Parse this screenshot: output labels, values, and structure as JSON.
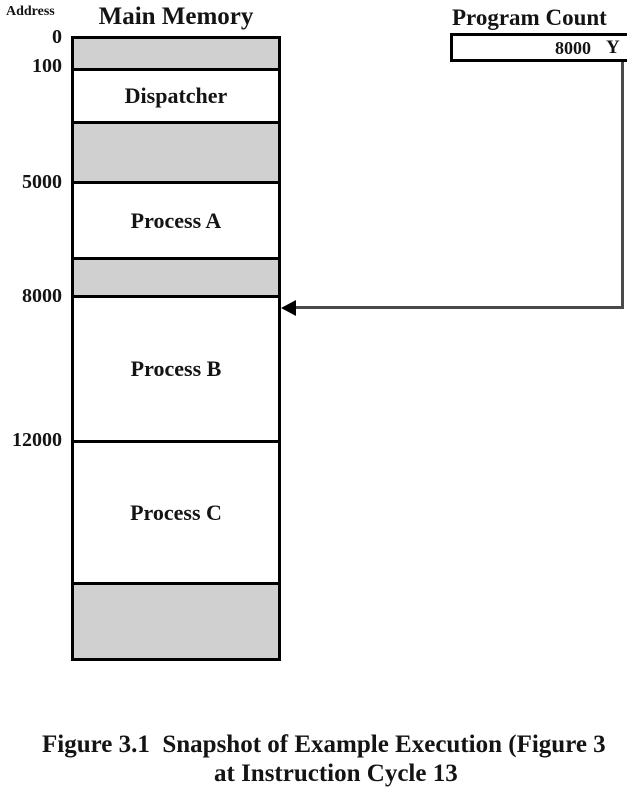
{
  "diagram": {
    "address_column_label": "Address",
    "memory": {
      "title": "Main Memory",
      "address_labels": [
        "0",
        "100",
        "5000",
        "8000",
        "12000"
      ],
      "regions": [
        {
          "start_address": "0",
          "label": "",
          "shaded": true
        },
        {
          "start_address": "100",
          "label": "Dispatcher",
          "shaded": false
        },
        {
          "start_address": "",
          "label": "",
          "shaded": true
        },
        {
          "start_address": "5000",
          "label": "Process A",
          "shaded": false
        },
        {
          "start_address": "",
          "label": "",
          "shaded": true
        },
        {
          "start_address": "8000",
          "label": "Process B",
          "shaded": false
        },
        {
          "start_address": "12000",
          "label": "Process C",
          "shaded": false
        },
        {
          "start_address": "",
          "label": "",
          "shaded": true
        }
      ]
    },
    "program_counter": {
      "title": "Program Count",
      "value": "8000",
      "partial_glyph": "Y",
      "points_to_address": "8000"
    },
    "caption": {
      "line1": "Figure 3.1  Snapshot of Example Execution (Figure 3",
      "line2": "at Instruction Cycle 13"
    },
    "colors": {
      "shaded_region": "#d0d0d0",
      "box_border": "#000000",
      "arrow_line": "#4a4a4a",
      "background": "#ffffff",
      "text": "#141414"
    }
  }
}
